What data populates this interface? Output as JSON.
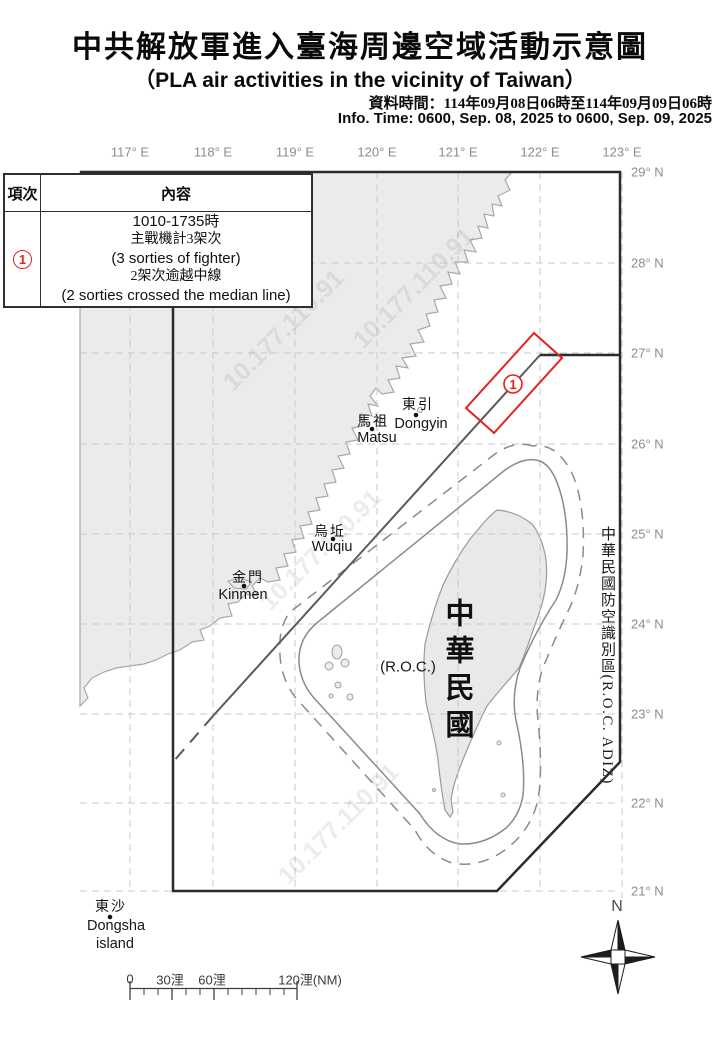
{
  "title": {
    "zh": "中共解放軍進入臺海周邊空域活動示意圖",
    "en": "（PLA air activities in the vicinity of Taiwan）",
    "info_zh": "資料時間：114年09月08日06時至114年09月09日06時",
    "info_en": "Info. Time: 0600, Sep. 08, 2025 to 0600, Sep. 09, 2025"
  },
  "table": {
    "col_index": "項次",
    "col_content": "內容",
    "row_index": "1",
    "lines": [
      {
        "text": "1010-1735時",
        "style": "en"
      },
      {
        "text": "主戰機計3架次",
        "style": "zh"
      },
      {
        "text": "(3 sorties of fighter)",
        "style": "en"
      },
      {
        "text": "2架次逾越中線",
        "style": "zh"
      },
      {
        "text": "(2 sorties crossed the median line)",
        "style": "en"
      }
    ]
  },
  "map": {
    "lon_labels": [
      {
        "text": "117° E",
        "x": 130
      },
      {
        "text": "118° E",
        "x": 213
      },
      {
        "text": "119° E",
        "x": 295
      },
      {
        "text": "120° E",
        "x": 377
      },
      {
        "text": "121° E",
        "x": 458
      },
      {
        "text": "122° E",
        "x": 540
      },
      {
        "text": "123° E",
        "x": 622
      }
    ],
    "lat_labels": [
      {
        "text": "29° N",
        "y": 172
      },
      {
        "text": "28° N",
        "y": 263
      },
      {
        "text": "27° N",
        "y": 353
      },
      {
        "text": "26° N",
        "y": 444
      },
      {
        "text": "25° N",
        "y": 534
      },
      {
        "text": "24° N",
        "y": 624
      },
      {
        "text": "23° N",
        "y": 714
      },
      {
        "text": "22° N",
        "y": 803
      },
      {
        "text": "21° N",
        "y": 891
      }
    ],
    "places": [
      {
        "zh": "東引",
        "en": "Dongyin",
        "zh_x": 418,
        "zh_y": 404,
        "dot_x": 416,
        "dot_y": 415,
        "en_x": 421,
        "en_y": 424
      },
      {
        "zh": "馬祖",
        "en": "Matsu",
        "zh_x": 373,
        "zh_y": 421,
        "dot_x": 372,
        "dot_y": 429,
        "en_x": 377,
        "en_y": 438
      },
      {
        "zh": "烏坵",
        "en": "Wuqiu",
        "zh_x": 330,
        "zh_y": 531,
        "dot_x": 333,
        "dot_y": 539,
        "en_x": 332,
        "en_y": 547
      },
      {
        "zh": "金門",
        "en": "Kinmen",
        "zh_x": 248,
        "zh_y": 577,
        "dot_x": 244,
        "dot_y": 586,
        "en_x": 243,
        "en_y": 595
      },
      {
        "zh": "東沙",
        "en": "Dongsha",
        "en2": "island",
        "zh_x": 111,
        "zh_y": 906,
        "dot_x": 110,
        "dot_y": 917,
        "en_x": 116,
        "en_y": 926,
        "en2_x": 115,
        "en2_y": 944
      }
    ],
    "roc_big": "中華民國",
    "roc_sub": "(R.O.C.)",
    "adiz_side_label": "中華民國防空識別區(R.O.C. ADIZ)",
    "marker": {
      "label": "1",
      "x": 513,
      "y": 384
    },
    "compass_label": "N",
    "watermark_text": "10.177.110.91",
    "watermarks": [
      {
        "x": 228,
        "y": 372
      },
      {
        "x": 265,
        "y": 592
      },
      {
        "x": 283,
        "y": 866
      },
      {
        "x": 358,
        "y": 330
      }
    ],
    "scale_labels": [
      {
        "text": "0",
        "x": 130
      },
      {
        "text": "30浬",
        "x": 170
      },
      {
        "text": "60浬",
        "x": 212
      },
      {
        "text": "120浬(NM)",
        "x": 310
      }
    ]
  },
  "colors": {
    "red": "#e3231a",
    "land": "#ebebeb",
    "coast": "#a8a8a8",
    "contour": "#8a8a8a",
    "median": "#5a5a5a",
    "adiz": "#2b2b2b",
    "grid": "#c8c8c8",
    "tick_text": "#8c8c8c"
  }
}
